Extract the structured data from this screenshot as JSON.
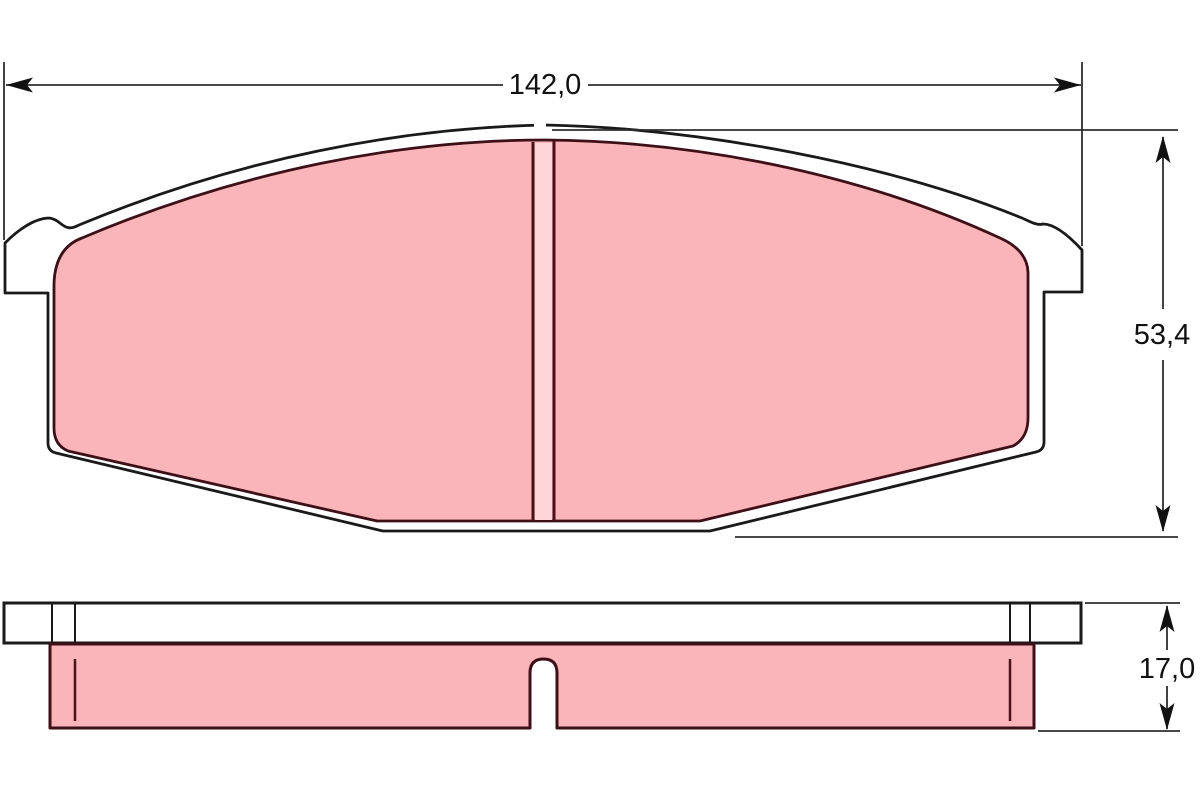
{
  "dimensions": {
    "width": {
      "label": "142,0"
    },
    "height": {
      "label": "53,4"
    },
    "thickness": {
      "label": "17,0"
    }
  },
  "colors": {
    "background": "#ffffff",
    "friction_pink": "#fab5bb",
    "friction_pink_light": "#fdd4d7",
    "friction_outline": "#3d0f16",
    "slot_line": "#4b1018",
    "plate_fill": "#ffffff",
    "plate_outline": "#1a1a1a",
    "dimension_line": "#2e2e2e",
    "dimension_text": "#111111"
  }
}
